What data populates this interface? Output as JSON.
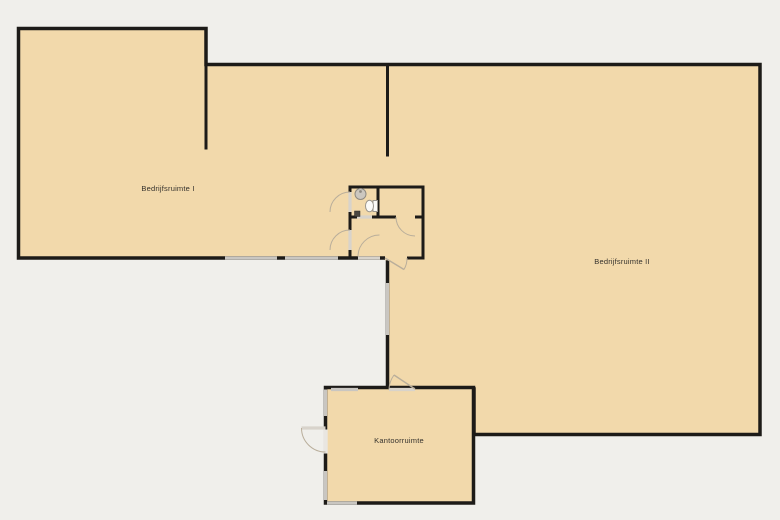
{
  "floorplan": {
    "colors": {
      "background": "#f0efeb",
      "room-fill": "#f2d9ab",
      "wall": "#1d1b18",
      "window": "#c9c6c1",
      "door-leaf": "#d8d3cb",
      "door-arc": "#b9ae9b",
      "text": "#35322d",
      "fixture-fill": "#ccc7bf",
      "fixture-stroke": "#8f8a82"
    },
    "rooms": [
      {
        "id": "bedrijfsruimte-1",
        "label": "Bedrijfsruimte I"
      },
      {
        "id": "bedrijfsruimte-2",
        "label": "Bedrijfsruimte II"
      },
      {
        "id": "kantoorruimte",
        "label": "Kantoorruimte"
      }
    ],
    "fixtures": [
      {
        "name": "sink"
      },
      {
        "name": "toilet"
      },
      {
        "name": "floor-drain"
      }
    ]
  }
}
